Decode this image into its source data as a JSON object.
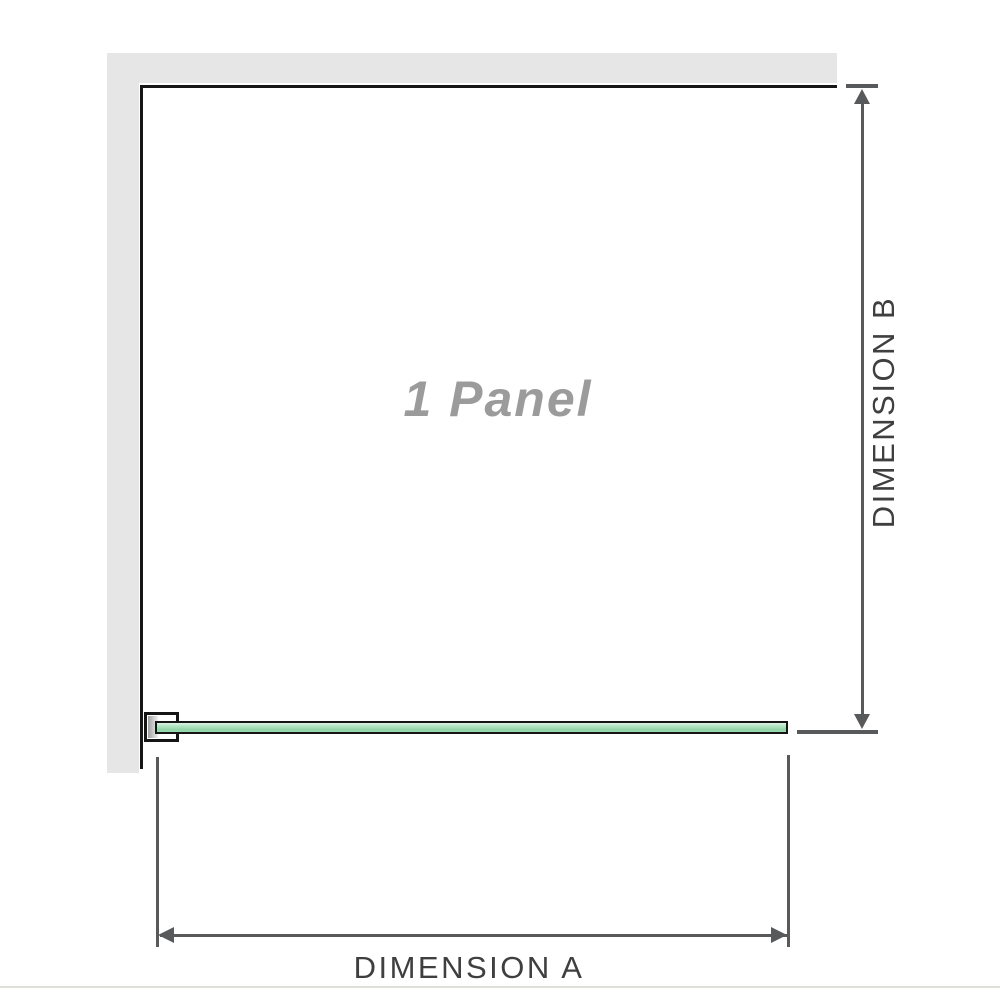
{
  "diagram": {
    "panel_label": "1 Panel",
    "dimension_a": {
      "label": "DIMENSION A"
    },
    "dimension_b": {
      "label": "DIMENSION B"
    },
    "colors": {
      "wall_fill": "#e6e6e6",
      "wall_edge": "#161616",
      "dimension_line": "#58595b",
      "dimension_label_text": "#3f3f3f",
      "panel_label_text": "#9b9b9b",
      "glass_outline": "#151515",
      "glass_green": "#9edcb2",
      "glass_green_light": "#dff2e4",
      "bracket_metal": "#9f9f9f",
      "bottom_divider": "#e1dfd9"
    }
  }
}
